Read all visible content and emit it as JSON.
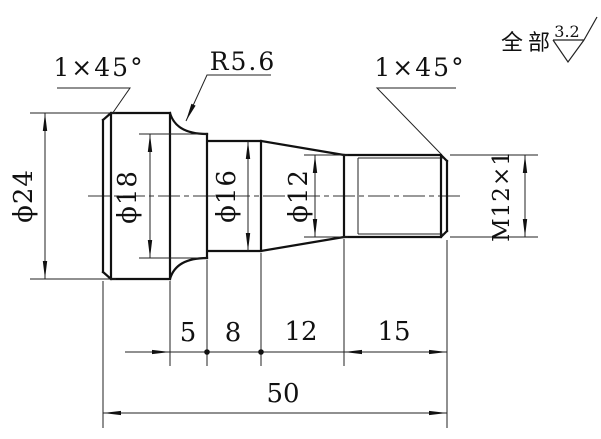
{
  "annotations": {
    "chamfer_left": "1×45°",
    "fillet": "R5.6",
    "chamfer_right": "1×45°"
  },
  "surface_finish": {
    "scope": "全部",
    "roughness": "3.2"
  },
  "diameters": {
    "d24": "ϕ24",
    "d18": "ϕ18",
    "d16": "ϕ16",
    "d12": "ϕ12",
    "thread": "M12×1"
  },
  "lengths": {
    "seg1": "5",
    "seg2": "8",
    "seg3": "12",
    "seg4": "15",
    "total": "50"
  }
}
